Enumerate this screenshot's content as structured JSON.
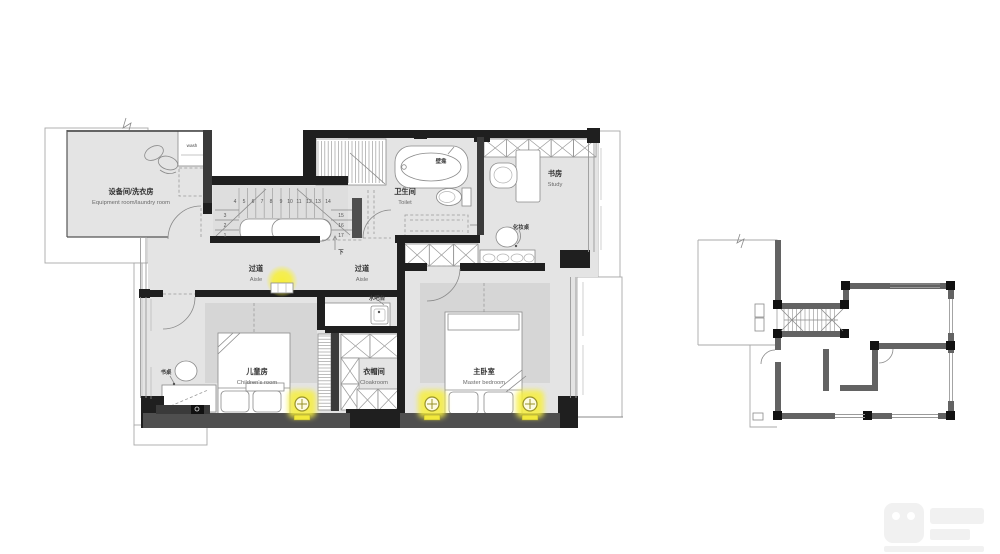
{
  "colors": {
    "floor_fill": "#e4e4e4",
    "stair_fill": "#dedede",
    "rug_fill": "#d6d6d6",
    "wall_dark": "#1f1f1f",
    "wall_gray": "#4f4f4f",
    "accent_yellow": "#f7ef3c",
    "accent_yellow_dark": "#99932a"
  },
  "rooms": {
    "equipment": {
      "zh": "设备间/洗衣房",
      "en": "Equipment room/laundry room"
    },
    "aisle_left": {
      "zh": "过道",
      "en": "Aisle"
    },
    "aisle_right": {
      "zh": "过道",
      "en": "Aisle"
    },
    "toilet": {
      "zh": "卫生间",
      "en": "Toilet"
    },
    "study": {
      "zh": "书房",
      "en": "Study"
    },
    "children": {
      "zh": "儿童房",
      "en": "Children's room"
    },
    "cloakroom": {
      "zh": "衣帽间",
      "en": "Cloakroom"
    },
    "master": {
      "zh": "主卧室",
      "en": "Master bedroom"
    }
  },
  "labels": {
    "wash": "wash",
    "niche": "壁龛",
    "water_bar": "水吧台",
    "dressing_table": "化妆桌",
    "desk": "书桌",
    "down": "下"
  },
  "stairs": {
    "left": [
      "3",
      "2",
      "1"
    ],
    "top": [
      "4",
      "5",
      "6",
      "7",
      "8",
      "9",
      "10",
      "11",
      "12",
      "13",
      "14"
    ],
    "right": [
      "15",
      "16",
      "17"
    ]
  }
}
